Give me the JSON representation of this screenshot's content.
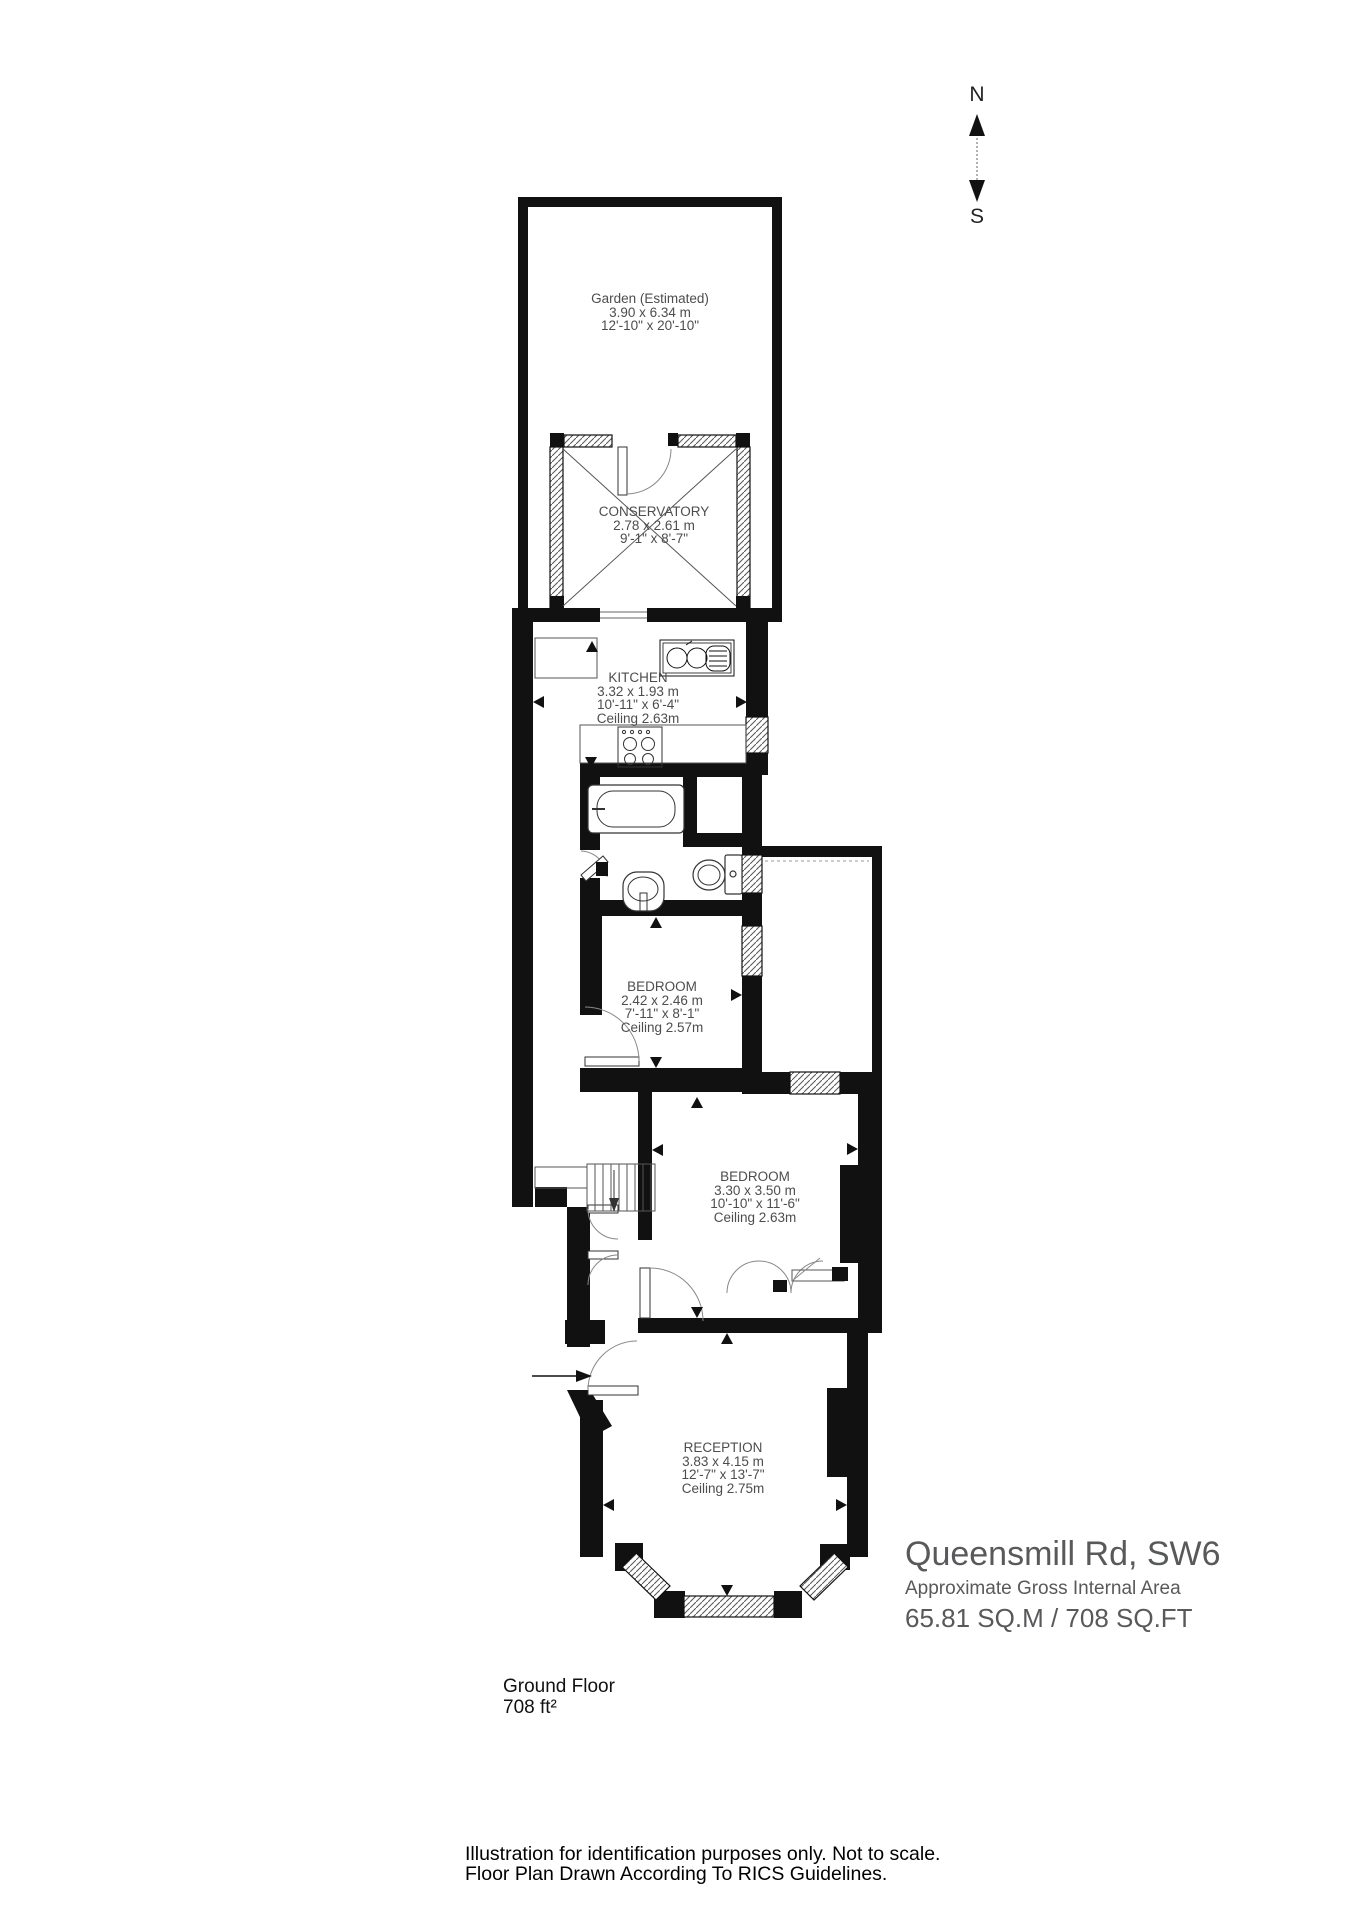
{
  "compass": {
    "north": "N",
    "south": "S"
  },
  "rooms": {
    "garden": {
      "name": "Garden (Estimated)",
      "metric": "3.90 x 6.34 m",
      "imperial": "12'-10\" x 20'-10\""
    },
    "conservatory": {
      "name": "CONSERVATORY",
      "metric": "2.78 x 2.61 m",
      "imperial": "9'-1\" x 8'-7\""
    },
    "kitchen": {
      "name": "KITCHEN",
      "metric": "3.32 x 1.93 m",
      "imperial": "10'-11\" x 6'-4\"",
      "ceiling": "Ceiling 2.63m"
    },
    "bedroom1": {
      "name": "BEDROOM",
      "metric": "2.42 x 2.46 m",
      "imperial": "7'-11\" x 8'-1\"",
      "ceiling": "Ceiling 2.57m"
    },
    "bedroom2": {
      "name": "BEDROOM",
      "metric": "3.30 x 3.50 m",
      "imperial": "10'-10\" x 11'-6\"",
      "ceiling": "Ceiling 2.63m"
    },
    "reception": {
      "name": "RECEPTION",
      "metric": "3.83 x 4.15 m",
      "imperial": "12'-7\" x 13'-7\"",
      "ceiling": "Ceiling 2.75m"
    }
  },
  "title_block": {
    "address": "Queensmill Rd, SW6",
    "subtitle": "Approximate Gross Internal Area",
    "area": "65.81 SQ.M / 708 SQ.FT"
  },
  "floor_label": {
    "name": "Ground Floor",
    "area": "708 ft²"
  },
  "footer": {
    "line1": "Illustration for identification purposes only. Not to scale.",
    "line2": "Floor Plan Drawn According To RICS Guidelines."
  },
  "colors": {
    "wall": "#111111",
    "room_text": "#4d4d4d",
    "title_text": "#58595b",
    "footer_text": "#000000"
  }
}
